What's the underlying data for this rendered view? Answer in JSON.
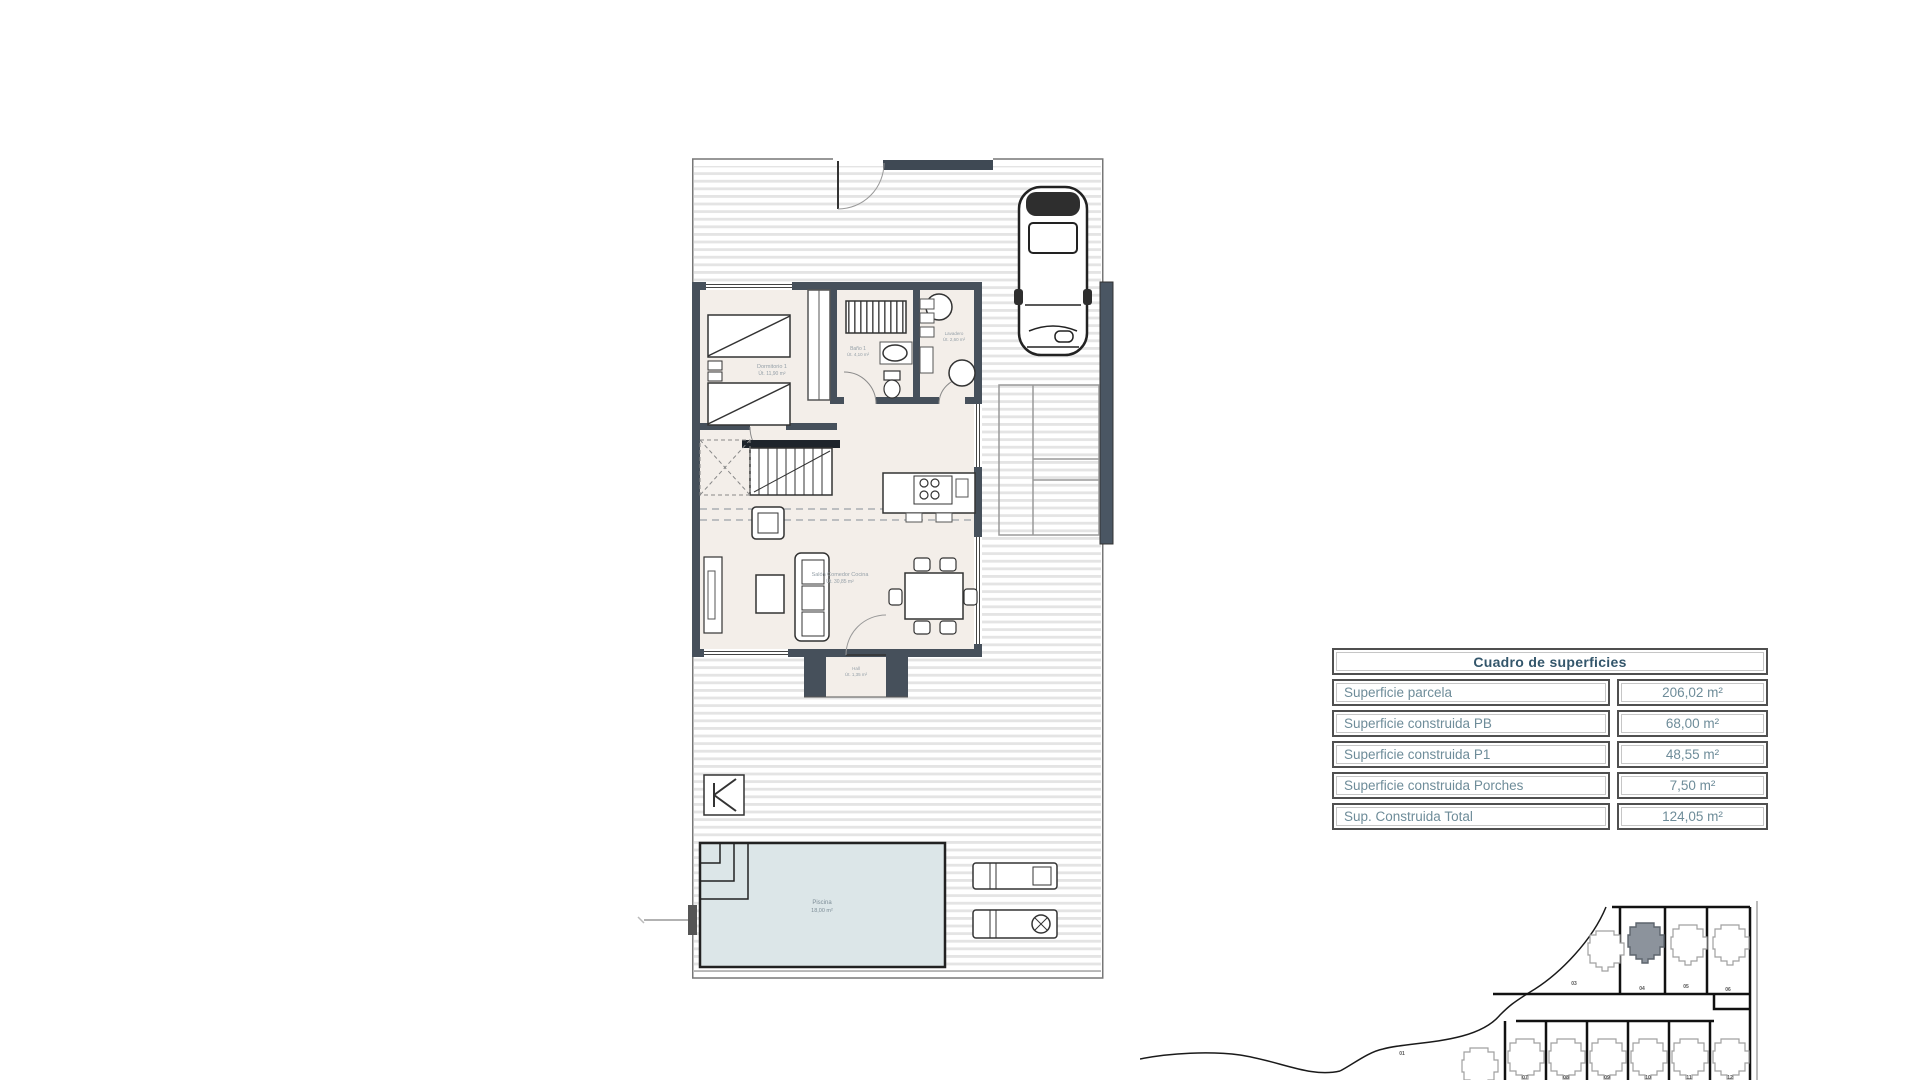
{
  "surface_table": {
    "title": "Cuadro de superficies",
    "rows": [
      {
        "label": "Superficie parcela",
        "value": "206,02 m²"
      },
      {
        "label": "Superficie construida PB",
        "value": "68,00 m²"
      },
      {
        "label": "Superficie construida P1",
        "value": "48,55 m²"
      },
      {
        "label": "Superficie construida Porches",
        "value": "7,50 m²"
      },
      {
        "label": "Sup. Construida Total",
        "value": "124,05 m²"
      }
    ]
  },
  "floor_plan": {
    "rooms": [
      {
        "name": "Dormitorio 1",
        "area": "Út. 11,90 m²"
      },
      {
        "name": "Baño 1",
        "area": "Út. 4,10 m²"
      },
      {
        "name": "Lavadero",
        "area": "Út. 2,60 m²"
      },
      {
        "name": "Salón Comedor Cocina",
        "area": "Út. 30,85 m²"
      },
      {
        "name": "Hall",
        "area": "Út. 1,35 m²"
      },
      {
        "name": "Piscina",
        "area": "18,00 m²"
      }
    ],
    "north_mark": "K"
  },
  "site_plan": {
    "highlighted_plot": "04",
    "plot_labels_top": [
      "03",
      "04",
      "05",
      "06"
    ],
    "plot_labels_bottom": [
      "01",
      "07",
      "08",
      "09",
      "10",
      "11",
      "12"
    ]
  },
  "colors": {
    "wall": "#46505b",
    "interior_floor": "#f3eee9",
    "pool_water": "#dce6e8",
    "hatch_line": "#e4e4e4",
    "table_text": "#6e8c99",
    "table_title": "#33566b",
    "highlight_plot_fill": "#8c939c"
  }
}
